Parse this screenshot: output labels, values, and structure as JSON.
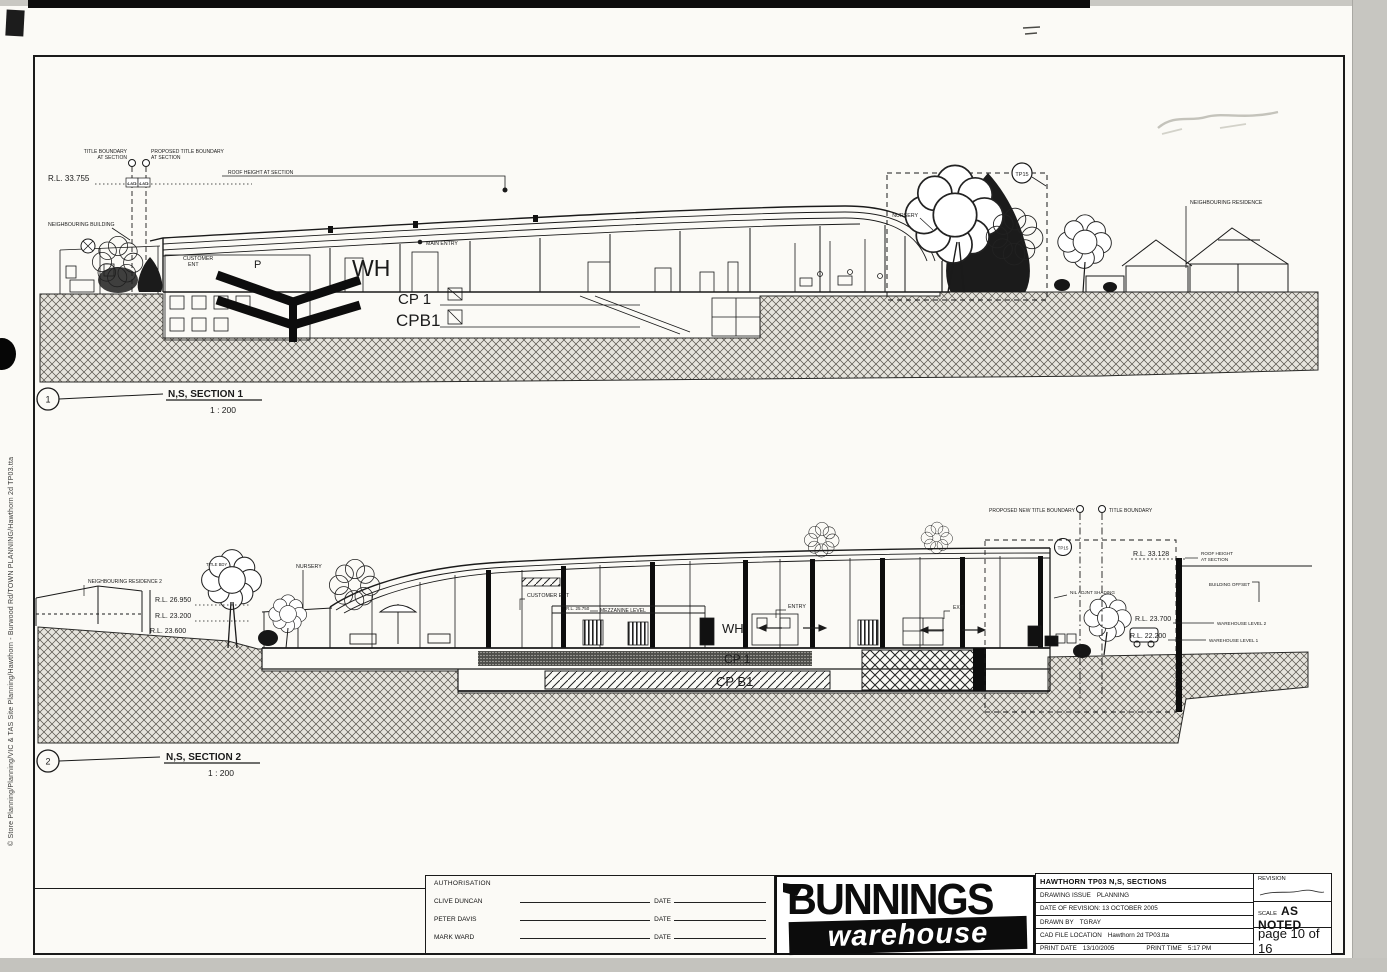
{
  "sheet": {
    "side_text": "© Store Planning/Planning/VIC & TAS Site Planning/Hawthorn - Burwood Rd/TOWN PLANNING/Hawthorn 2d TP03.tta"
  },
  "s1": {
    "num": "1",
    "title": "N,S, SECTION 1",
    "scale": "1 : 200",
    "rl_roof": "R.L. 33.755",
    "bdy_a1": "TITLE BOUNDARY",
    "bdy_a2": "AT SECTION",
    "bdy_b1": "PROPOSED TITLE BOUNDARY",
    "bdy_b2": "AT SECTION",
    "dim1": "LAD",
    "dim2": "LAD",
    "neigh_bldg": "NEIGHBOURING BUILDING",
    "roof_note": "ROOF HEIGHT AT SECTION",
    "customer1": "CUSTOMER",
    "customer2": "ENT",
    "p": "P",
    "wh": "WH",
    "main_entry": "MAIN ENTRY",
    "cp1": "CP 1",
    "cpb1": "CPB1",
    "nursery": "NURSERY",
    "tp": "TP15",
    "neigh_res": "NEIGHBOURING RESIDENCE"
  },
  "s2": {
    "num": "2",
    "title": "N,S, SECTION 2",
    "scale": "1 : 200",
    "neigh_res2": "NEIGHBOURING RESIDENCE 2",
    "rl1": "R.L. 26.950",
    "rl2": "R.L. 23.200",
    "rl3": "R.L. 23.600",
    "tbdy_tree": "TITLE BDY",
    "nursery": "NURSERY",
    "customer": "CUSTOMER ENT",
    "rl_mezz": "R.L. 25.750",
    "mezz": "MEZZANINE LEVEL",
    "wh": "WH",
    "entry": "ENTRY",
    "exit": "EXIT",
    "cp1": "CP 1",
    "cpb1": "CP B1",
    "pbdy": "PROPOSED NEW TITLE BOUNDARY",
    "tbdy": "TITLE BOUNDARY",
    "tp": "TP15",
    "rl_roof": "R.L. 33.128",
    "roof_note1": "ROOF HEIGHT",
    "roof_note2": "AT SECTION",
    "bldg_offset": "BUILDING OFFSET",
    "shading": "NIL ADJNT SHADING",
    "rl_l2": "R.L. 23.700",
    "lvl2": "WAREHOUSE LEVEL 2",
    "rl_l1": "R.L. 22.200",
    "lvl1": "WAREHOUSE LEVEL 1"
  },
  "tb": {
    "auth": {
      "header": "AUTHORISATION",
      "names": [
        "CLIVE DUNCAN",
        "PETER DAVIS",
        "MARK WARD"
      ],
      "date": "DATE"
    },
    "logo": {
      "top": "BUNNINGS",
      "bottom": "warehouse"
    },
    "rows": {
      "title": "HAWTHORN TP03   N,S, SECTIONS",
      "issue_label": "DRAWING ISSUE",
      "issue": "PLANNING",
      "rev": "DATE OF REVISION: 13 OCTOBER 2005",
      "drawn_label": "DRAWN BY",
      "drawn": "TGRAY",
      "cad_label": "CAD FILE LOCATION",
      "cad": "Hawthorn 2d TP03.tta",
      "print_label": "PRINT DATE",
      "print": "13/10/2005",
      "ptime_label": "PRINT TIME",
      "ptime": "5:17 PM"
    },
    "revision": "REVISION",
    "scale_label": "SCALE",
    "scale": "AS NOTED",
    "page": "page 10 of 16"
  }
}
